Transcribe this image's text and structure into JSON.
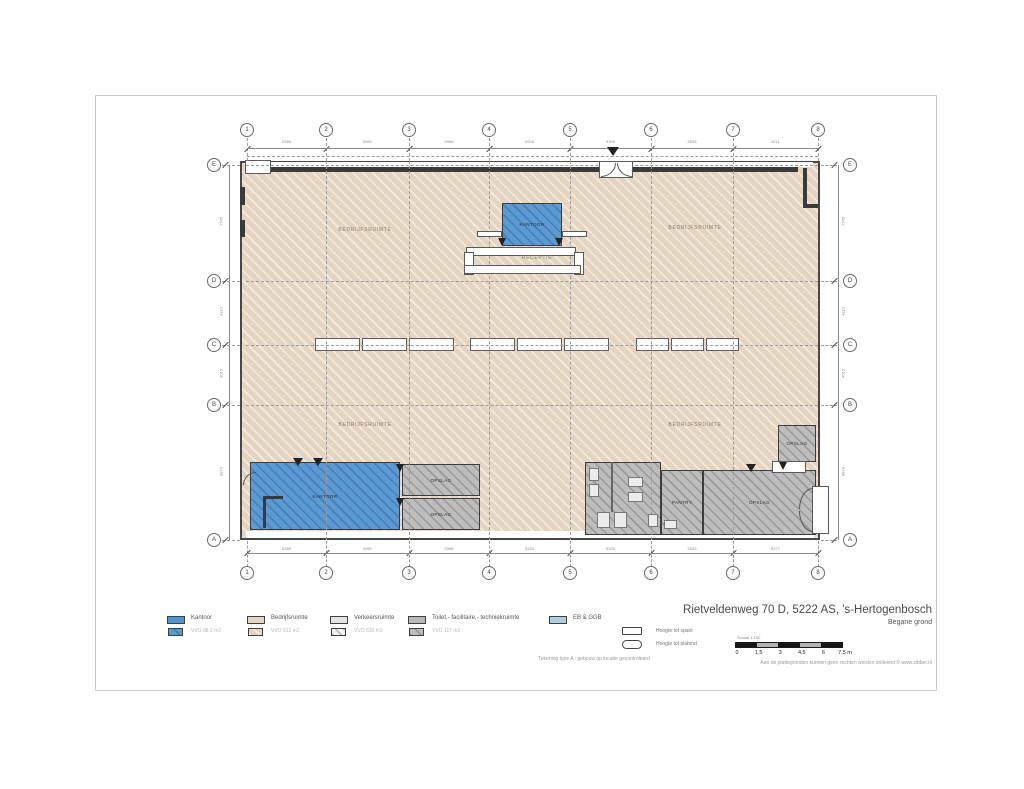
{
  "title_block": {
    "address": "Rietveldenweg 70 D, 5222 AS, 's-Hertogenbosch",
    "floor": "Begane grond"
  },
  "notes": {
    "type_note": "Tekening type A : gebouw op locatie gecontroleerd",
    "disclaimer": "Aan de plattegronden kunnen geen rechten worden ontleend © www.zibber.nl"
  },
  "scale_bar": {
    "caption": "Schaal 1:150",
    "ticks": [
      "0",
      "1,5",
      "3",
      "4,5",
      "6",
      "7,5"
    ],
    "unit": "m",
    "segment_colors": [
      "#161616",
      "#b4b4b4",
      "#161616",
      "#b4b4b4",
      "#161616"
    ]
  },
  "legend": {
    "items": [
      {
        "label": "Kantoor",
        "sub": "VVO 88.3 m2",
        "color": "#4f94d0",
        "hatch": "fill-blue",
        "x": 167
      },
      {
        "label": "Bedrijfsruimte",
        "sub": "VVO 912 m2",
        "color": "#e5d5c0",
        "hatch": "fill-tan",
        "x": 247
      },
      {
        "label": "Verkeersruimte",
        "sub": "VVO 630 m2",
        "color": "#e4e4e4",
        "hatch": "fill-whitehatch",
        "x": 330
      },
      {
        "label": "Toilet,- facilitaire,- techniekruimte",
        "sub": "VVO 117 m2",
        "color": "#b9b9b9",
        "hatch": "fill-gray",
        "x": 408
      },
      {
        "label": "EB & GGB",
        "sub": "",
        "color": "#aecfe0",
        "hatch": "",
        "x": 549
      }
    ],
    "keys": [
      {
        "shape": "rect",
        "label": "Hoogte tot spant"
      },
      {
        "shape": "stadium",
        "label": "Hoogte tot plafond"
      }
    ]
  },
  "plan": {
    "colors": {
      "wall": "#474747",
      "bedrijfsruimte": "#e5d5c0",
      "kantoor": "#5b9ad3",
      "opslag": "#bdbdbd",
      "grid_dash": "#9a9a9a"
    },
    "columns": [
      {
        "label": "1",
        "x": 247
      },
      {
        "label": "2",
        "x": 326
      },
      {
        "label": "3",
        "x": 409
      },
      {
        "label": "4",
        "x": 489
      },
      {
        "label": "5",
        "x": 570
      },
      {
        "label": "6",
        "x": 651
      },
      {
        "label": "7",
        "x": 733
      },
      {
        "label": "8",
        "x": 818
      }
    ],
    "rows": [
      {
        "label": "E",
        "y": 165,
        "inner": true
      },
      {
        "label": "D",
        "y": 281,
        "inner": true
      },
      {
        "label": "C",
        "y": 345,
        "inner": true
      },
      {
        "label": "B",
        "y": 405,
        "inner": true
      },
      {
        "label": "A",
        "y": 540,
        "inner": false
      }
    ],
    "dims_top": [
      "5385",
      "5982",
      "5556",
      "5926",
      "5395",
      "5543",
      "5211"
    ],
    "dims_bottom": [
      "5385",
      "5982",
      "5398",
      "5320",
      "5395",
      "5543",
      "5377"
    ],
    "dims_left": [
      "7745",
      "4110",
      "4015",
      "8970"
    ],
    "dims_right": [
      "7745",
      "4110",
      "4015",
      "8970"
    ],
    "rooms": [
      {
        "name": "kantoor-top",
        "label": "KANTOOR",
        "type": "blue",
        "x": 502,
        "y": 203,
        "w": 60,
        "h": 43
      },
      {
        "name": "kantoor-bottom",
        "label": "KANTOOR",
        "type": "blue",
        "x": 250,
        "y": 462,
        "w": 150,
        "h": 68
      },
      {
        "name": "opslag-1",
        "label": "OPSLAG",
        "type": "gray",
        "x": 402,
        "y": 464,
        "w": 78,
        "h": 32
      },
      {
        "name": "opslag-2",
        "label": "OPSLAG",
        "type": "gray",
        "x": 402,
        "y": 498,
        "w": 78,
        "h": 32
      },
      {
        "name": "sanitair",
        "label": "",
        "type": "gray",
        "x": 585,
        "y": 462,
        "w": 76,
        "h": 73
      },
      {
        "name": "pantry",
        "label": "PANTRY",
        "type": "gray",
        "x": 661,
        "y": 470,
        "w": 42,
        "h": 65
      },
      {
        "name": "opslag-3",
        "label": "OPSLAG",
        "type": "gray",
        "x": 703,
        "y": 470,
        "w": 113,
        "h": 65
      },
      {
        "name": "opslag-4",
        "label": "OPSLAG",
        "type": "gray",
        "x": 778,
        "y": 425,
        "w": 38,
        "h": 37
      }
    ],
    "area_labels": [
      {
        "text": "BEDRIJFSRUIMTE",
        "x": 365,
        "y": 230
      },
      {
        "text": "BEDRIJFSRUIMTE",
        "x": 695,
        "y": 228
      },
      {
        "text": "BEDRIJFSRUIMTE",
        "x": 365,
        "y": 425
      },
      {
        "text": "BEDRIJFSRUIMTE",
        "x": 695,
        "y": 425
      },
      {
        "text": "RECEPTIE",
        "x": 537,
        "y": 258
      }
    ],
    "skylights": [
      {
        "x": 315,
        "y": 338,
        "cells": 3,
        "cw": 45,
        "h": 13
      },
      {
        "x": 470,
        "y": 338,
        "cells": 3,
        "cw": 45,
        "h": 13
      },
      {
        "x": 636,
        "y": 338,
        "cells": 3,
        "cw": 33,
        "h": 13
      }
    ],
    "details": [
      {
        "name": "top-inner-strip",
        "kind": "rect",
        "style": "plainwhite",
        "layer": 1,
        "x": 247,
        "y": 162,
        "w": 566,
        "h": 5
      },
      {
        "name": "bottom-corridor-strip",
        "kind": "rect",
        "style": "plainwhite",
        "layer": 1,
        "x": 246,
        "y": 531,
        "w": 568,
        "h": 7
      },
      {
        "name": "top-wall-band",
        "kind": "rect",
        "style": "dark",
        "layer": 1,
        "x": 252,
        "y": 167,
        "w": 546,
        "h": 5
      },
      {
        "name": "top-left-notch",
        "kind": "rect",
        "style": "white",
        "layer": 1,
        "x": 245,
        "y": 160,
        "w": 26,
        "h": 14
      },
      {
        "name": "left-wall-door-1",
        "kind": "rect",
        "style": "dark",
        "layer": 1,
        "x": 240,
        "y": 187,
        "w": 5,
        "h": 18
      },
      {
        "name": "left-wall-door-2",
        "kind": "rect",
        "style": "dark",
        "layer": 1,
        "x": 240,
        "y": 220,
        "w": 5,
        "h": 17
      },
      {
        "name": "top-right-wall-v",
        "kind": "rect",
        "style": "dark",
        "layer": 1,
        "x": 803,
        "y": 168,
        "w": 4,
        "h": 40
      },
      {
        "name": "top-right-wall-h",
        "kind": "rect",
        "style": "dark",
        "layer": 1,
        "x": 803,
        "y": 204,
        "w": 15,
        "h": 4
      },
      {
        "name": "entrance-door",
        "kind": "rect",
        "style": "white",
        "layer": 2,
        "x": 599,
        "y": 161,
        "w": 34,
        "h": 17
      },
      {
        "name": "entrance-leaf-left",
        "kind": "arc-br",
        "layer": 2,
        "x": 601,
        "y": 163,
        "w": 15,
        "h": 14
      },
      {
        "name": "entrance-leaf-right",
        "kind": "arc-bl",
        "layer": 2,
        "x": 617,
        "y": 163,
        "w": 15,
        "h": 14
      },
      {
        "name": "entrance-marker",
        "kind": "tri",
        "layer": 2,
        "x": 607,
        "y": 147,
        "w": 12,
        "h": 9
      },
      {
        "name": "reception-band-1",
        "kind": "rect",
        "style": "white",
        "layer": 2,
        "x": 466,
        "y": 247,
        "w": 110,
        "h": 9
      },
      {
        "name": "reception-wing-left",
        "kind": "rect",
        "style": "white",
        "layer": 2,
        "x": 464,
        "y": 252,
        "w": 10,
        "h": 23
      },
      {
        "name": "reception-wing-right",
        "kind": "rect",
        "style": "white",
        "layer": 2,
        "x": 574,
        "y": 252,
        "w": 10,
        "h": 23
      },
      {
        "name": "reception-band-2",
        "kind": "rect",
        "style": "white",
        "layer": 2,
        "x": 464,
        "y": 265,
        "w": 117,
        "h": 9
      },
      {
        "name": "kantoor-top-bar-left",
        "kind": "rect",
        "style": "white",
        "layer": 2,
        "x": 477,
        "y": 231,
        "w": 25,
        "h": 6
      },
      {
        "name": "kantoor-top-bar-right",
        "kind": "rect",
        "style": "white",
        "layer": 2,
        "x": 562,
        "y": 231,
        "w": 25,
        "h": 6
      },
      {
        "name": "kantoor-top-door-left",
        "kind": "tri",
        "layer": 2,
        "x": 498,
        "y": 238,
        "w": 9,
        "h": 8
      },
      {
        "name": "kantoor-top-door-right",
        "kind": "tri",
        "layer": 2,
        "x": 555,
        "y": 238,
        "w": 9,
        "h": 8
      },
      {
        "name": "kantoor-bottom-door-1",
        "kind": "tri",
        "layer": 2,
        "x": 293,
        "y": 458,
        "w": 10,
        "h": 8
      },
      {
        "name": "kantoor-bottom-door-2",
        "kind": "tri",
        "layer": 2,
        "x": 313,
        "y": 458,
        "w": 10,
        "h": 8
      },
      {
        "name": "kantoor-bottom-wall-v",
        "kind": "rect",
        "style": "dark",
        "layer": 2,
        "x": 263,
        "y": 496,
        "w": 3,
        "h": 32
      },
      {
        "name": "kantoor-bottom-wall-h",
        "kind": "rect",
        "style": "dark",
        "layer": 2,
        "x": 263,
        "y": 496,
        "w": 20,
        "h": 3
      },
      {
        "name": "kantoor-bottom-entry-arc",
        "kind": "arc-tl",
        "layer": 2,
        "x": 243,
        "y": 472,
        "w": 13,
        "h": 13
      },
      {
        "name": "opslag-1-door",
        "kind": "tri",
        "layer": 2,
        "x": 396,
        "y": 464,
        "w": 9,
        "h": 8
      },
      {
        "name": "opslag-2-door",
        "kind": "tri",
        "layer": 2,
        "x": 396,
        "y": 498,
        "w": 9,
        "h": 8
      },
      {
        "name": "sanitair-wall",
        "kind": "rect",
        "style": "darkthin",
        "layer": 2,
        "x": 611,
        "y": 462,
        "w": 2,
        "h": 50
      },
      {
        "name": "wc-1",
        "kind": "rect",
        "style": "fix",
        "layer": 2,
        "x": 589,
        "y": 468,
        "w": 10,
        "h": 13
      },
      {
        "name": "wc-2",
        "kind": "rect",
        "style": "fix",
        "layer": 2,
        "x": 589,
        "y": 484,
        "w": 10,
        "h": 13
      },
      {
        "name": "wc-3",
        "kind": "rect",
        "style": "fix",
        "layer": 2,
        "x": 597,
        "y": 512,
        "w": 13,
        "h": 16
      },
      {
        "name": "wc-4",
        "kind": "rect",
        "style": "fix",
        "layer": 2,
        "x": 614,
        "y": 512,
        "w": 13,
        "h": 16
      },
      {
        "name": "wc-5",
        "kind": "rect",
        "style": "fix",
        "layer": 2,
        "x": 628,
        "y": 477,
        "w": 15,
        "h": 10
      },
      {
        "name": "wc-6",
        "kind": "rect",
        "style": "fix",
        "layer": 2,
        "x": 628,
        "y": 492,
        "w": 15,
        "h": 10
      },
      {
        "name": "wc-7",
        "kind": "rect",
        "style": "fix",
        "layer": 2,
        "x": 648,
        "y": 514,
        "w": 10,
        "h": 13
      },
      {
        "name": "pantry-sink",
        "kind": "rect",
        "style": "fix",
        "layer": 2,
        "x": 664,
        "y": 520,
        "w": 13,
        "h": 9
      },
      {
        "name": "opslag-3-door",
        "kind": "tri",
        "layer": 2,
        "x": 746,
        "y": 464,
        "w": 10,
        "h": 8
      },
      {
        "name": "opslag-4-door-rect",
        "kind": "rect",
        "style": "white",
        "layer": 2,
        "x": 772,
        "y": 461,
        "w": 34,
        "h": 12
      },
      {
        "name": "opslag-4-door",
        "kind": "tri",
        "layer": 2,
        "x": 779,
        "y": 462,
        "w": 9,
        "h": 8
      },
      {
        "name": "right-door",
        "kind": "rect",
        "style": "white",
        "layer": 2,
        "x": 812,
        "y": 486,
        "w": 17,
        "h": 48
      },
      {
        "name": "right-door-leaf-1",
        "kind": "arc-tl",
        "layer": 2,
        "x": 799,
        "y": 488,
        "w": 14,
        "h": 21
      },
      {
        "name": "right-door-leaf-2",
        "kind": "arc-bl",
        "layer": 2,
        "x": 799,
        "y": 511,
        "w": 14,
        "h": 21
      }
    ]
  }
}
